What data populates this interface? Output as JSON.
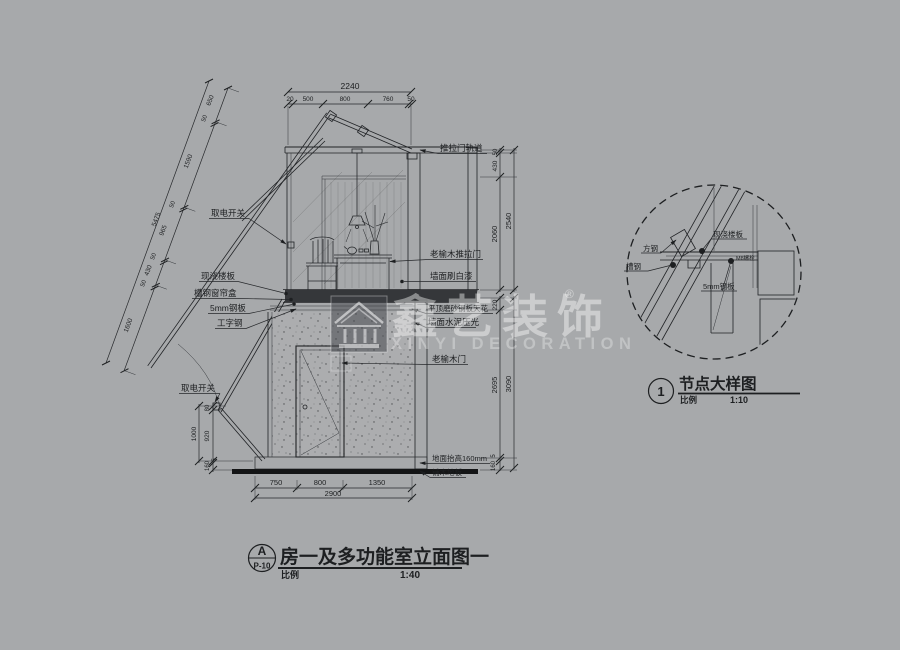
{
  "watermark": {
    "cn": "鑫艺装饰",
    "reg": "®",
    "en": "XINYI DECORATION"
  },
  "main_title": {
    "bubble_top": "A",
    "bubble_bottom": "P-10",
    "title": "房一及多功能室立面图一",
    "scale_label": "比例",
    "scale_value": "1:40"
  },
  "detail_title": {
    "bubble": "1",
    "title": "节点大样图",
    "scale_label": "比例",
    "scale_value": "1:10"
  },
  "dims": {
    "top": {
      "total": "2240",
      "segs": [
        "20",
        "500",
        "800",
        "760",
        "50"
      ]
    },
    "bottom": {
      "total": "2900",
      "segs": [
        "750",
        "800",
        "1350"
      ]
    },
    "right_upper": {
      "total": "2540",
      "segs": [
        "50",
        "430",
        "2060"
      ]
    },
    "right_lower": {
      "total": "3090",
      "segs": [
        "220",
        "2695"
      ],
      "plate": "5",
      "floor": "160"
    },
    "left_vert": {
      "total": "1000",
      "segs": [
        "80",
        "920"
      ],
      "plate": "5",
      "floor": "160"
    },
    "left_angled": {
      "total": "5475",
      "segs": [
        "650",
        "50",
        "1590",
        "50",
        "965",
        "50",
        "430",
        "50"
      ],
      "lower": "1600"
    }
  },
  "labels": {
    "track": "推拉门轨道",
    "switch_upper": "取电开关",
    "switch_lower": "取电开关",
    "slab": "现浇楼板",
    "curtain_box": "槽钢窗帘盒",
    "steel_plate": "5mm钢板",
    "i_beam": "工字钢",
    "sliding_door": "老榆木推拉门",
    "wall_paint": "墙面刷白漆",
    "ceiling": "平顶磨砂钢板天花",
    "wall_cement": "墙面水泥压光",
    "wood_door": "老榆木门",
    "floor_raise": "地面抬高160mm",
    "wood_floor": "铺木地板"
  },
  "detail_labels": {
    "square_steel": "方钢",
    "channel_steel": "槽钢",
    "slab": "现浇楼板",
    "bolt": "M8螺栓",
    "steel_plate": "5mm钢板"
  }
}
